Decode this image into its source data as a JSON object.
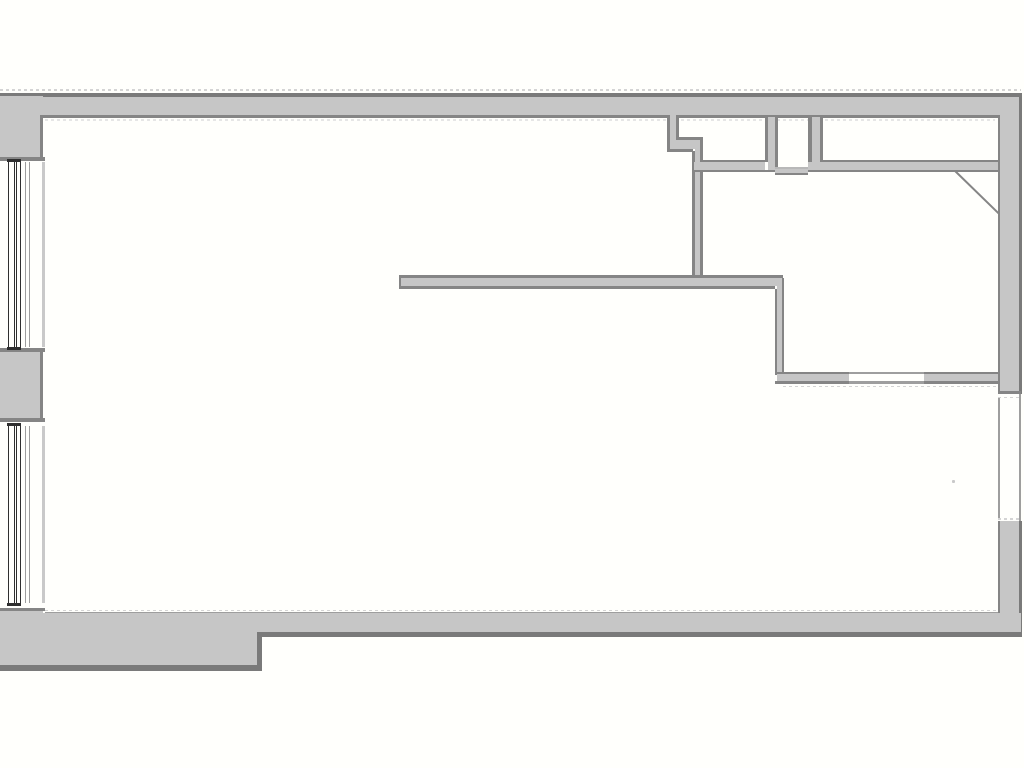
{
  "document": {
    "kind": "architectural-floor-plan",
    "visible_text": "",
    "elements": [
      "exterior-top-wall",
      "exterior-right-wall",
      "exterior-bottom-wall-with-step",
      "left-wall-with-two-windows",
      "left-window-upper",
      "left-window-lower",
      "left-wall-pier",
      "small-room-top-left-of-cluster",
      "door-niche-between-small-rooms",
      "small-room-top-right",
      "middle-right-room",
      "long-interior-partition-wall",
      "interior-stepped-partition-wall",
      "door-swing-diagonal",
      "right-side-wall-opening",
      "bottom-wall-window-opening"
    ]
  },
  "colors": {
    "background": "#fffffc",
    "wall_fill": "#c6c6c6",
    "edge_outer": "#7a7a7a",
    "edge": "#858585",
    "line_medium": "#9e9e9e",
    "line_light": "#c9c9c9",
    "window_frame": "#2f2f2f",
    "dash": "#d4d4d4",
    "dash_faint": "#e6e6e6",
    "threshold_light": "#b8b8b8"
  }
}
